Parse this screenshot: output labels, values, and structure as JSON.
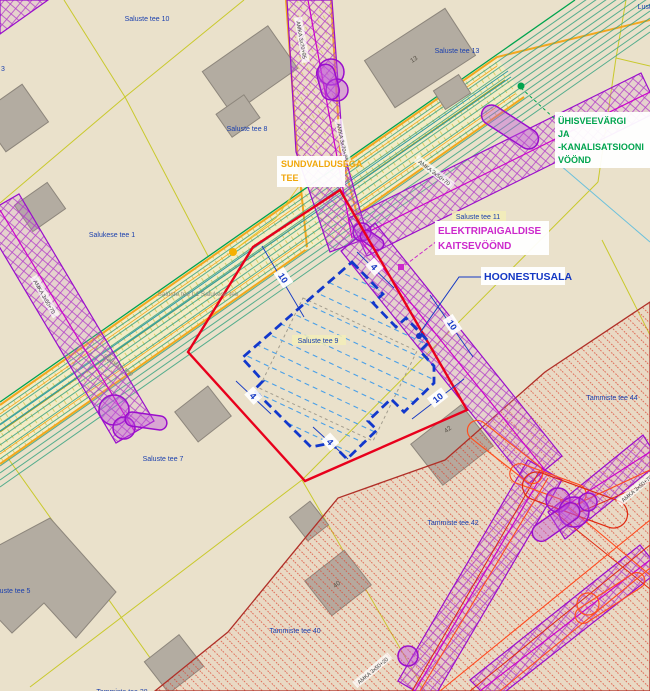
{
  "colors": {
    "background": "#eae1cb",
    "parcelLine": "#c9c92c",
    "roadBorder": "#f2a71f",
    "waterLine": "#2e9aa6",
    "greenZone": "#3aa383",
    "greenText": "#00a44e",
    "purpleEdge": "#9a0ecc",
    "cableLine": "#cc00cc",
    "redRect": "#e8001c",
    "blueShape": "#1238cc",
    "blueHatch": "#4aa0e8",
    "redZoneBorder": "#b03028",
    "powerLine": "#ff4a1e",
    "building": "#b3aca1",
    "buildingEdge": "#8d867c",
    "labelBlue": "#1a3fae",
    "labelGray": "#8a897b",
    "calloutOrange": "#f0a70a",
    "calloutMagenta": "#cc29cc",
    "dimBlue": "#1337c4"
  },
  "labels": {
    "parcels": [
      {
        "text": "Saluste tee 10"
      },
      {
        "text": "Saluste tee 8"
      },
      {
        "text": "Saluste tee 13"
      },
      {
        "text": "Salukese tee 1"
      },
      {
        "text": "Saluste tee 11"
      },
      {
        "text": "Saluste tee 9"
      },
      {
        "text": "Saluste tee 7"
      },
      {
        "text": "Saluste tee 5"
      },
      {
        "text": "Tammiste tee 44"
      },
      {
        "text": "Tammiste tee 42"
      },
      {
        "text": "Tammiste tee 40"
      },
      {
        "text": "Tammiste tee 38"
      },
      {
        "text": "Lusti"
      },
      {
        "text": "3"
      },
      {
        "text": "Saluste tee L1 Salukese tee"
      },
      {
        "text": "Saluste tee"
      }
    ],
    "buildings": [
      {
        "text": "13"
      },
      {
        "text": "42"
      },
      {
        "text": "40"
      }
    ],
    "cables": [
      {
        "text": "AMKA 3x70+95"
      },
      {
        "text": "AMKA 3x70+95"
      },
      {
        "text": "AMKA 3x50+70"
      },
      {
        "text": "AMKA 3x50+70"
      },
      {
        "text": "AMKA 3x50+20"
      },
      {
        "text": "AMKA 3x50+70"
      }
    ],
    "dims": [
      {
        "text": "10"
      },
      {
        "text": "4"
      },
      {
        "text": "10"
      },
      {
        "text": "4"
      },
      {
        "text": "4"
      },
      {
        "text": "10"
      }
    ],
    "callouts": {
      "sundvaldusega": {
        "l1": "SUNDVALDUSEGA",
        "l2": "TEE"
      },
      "veevark": {
        "l1": "ÜHISVEEVÄRGI",
        "l2": "JA",
        "l3": "-KANALISATSIOONI",
        "l4": "VÖÖND"
      },
      "elekter": {
        "l1": "ELEKTRIPAIGALDISE",
        "l2": "KAITSEVÖÖND"
      },
      "hoonestusala": {
        "l1": "HOONESTUSALA"
      }
    }
  }
}
